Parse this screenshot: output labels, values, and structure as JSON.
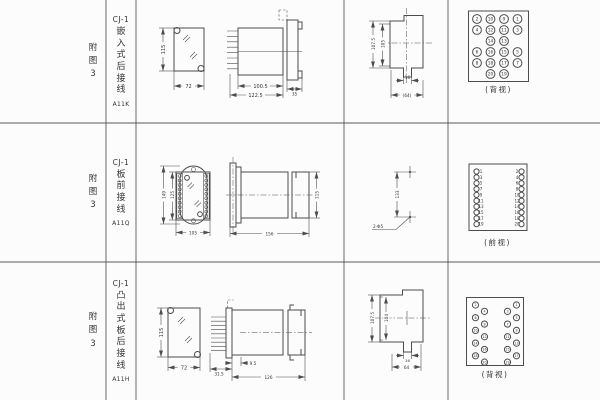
{
  "page": {
    "background": "#fcfcfc",
    "ink": "#4d4d4d"
  },
  "rows": [
    {
      "fig_chars": [
        "附",
        "图",
        "3"
      ],
      "model": "CJ-1",
      "mount_chars": [
        "嵌",
        "入",
        "式",
        "后",
        "接",
        "线"
      ],
      "code": "A11K",
      "front": {
        "h": "115",
        "w": "72"
      },
      "side": {
        "d1": "100.5",
        "d2": "122.5",
        "d3": "35"
      },
      "cutout": {
        "h1": "107.5",
        "h2": "105",
        "w1": "16",
        "w2": "(64)"
      },
      "terminal_view": {
        "caption": "(背视)",
        "grid": [
          [
            2,
            10,
            9,
            1
          ],
          [
            4,
            12,
            11,
            3
          ],
          [
            null,
            14,
            13,
            null
          ],
          [
            6,
            16,
            15,
            5
          ],
          [
            8,
            18,
            17,
            7
          ],
          [
            null,
            20,
            19,
            null
          ]
        ]
      }
    },
    {
      "fig_chars": [
        "附",
        "图",
        "3"
      ],
      "model": "CJ-1",
      "mount_chars": [
        "板",
        "前",
        "接",
        "线"
      ],
      "code": "A11Q",
      "front": {
        "h1": "149",
        "h2": "125",
        "w": "105"
      },
      "side": {
        "len": "156",
        "h": "115"
      },
      "holes": {
        "dist": "133",
        "label": "2-Φ5"
      },
      "terminal_view": {
        "caption": "(前视)",
        "left": [
          1,
          3,
          5,
          7,
          9,
          11,
          13,
          15,
          17,
          19
        ],
        "right": [
          2,
          4,
          6,
          8,
          10,
          12,
          14,
          16,
          18,
          20
        ]
      }
    },
    {
      "fig_chars": [
        "附",
        "图",
        "3"
      ],
      "model": "CJ-1",
      "mount_chars": [
        "凸",
        "出",
        "式",
        "板",
        "后",
        "接",
        "线"
      ],
      "code": "A11H",
      "front": {
        "h": "115",
        "w": "72"
      },
      "side": {
        "d1": "9.5",
        "d2": "31.5",
        "d3": "126"
      },
      "cutout": {
        "h1": "107.5",
        "h2": "104",
        "w1": "16",
        "w2": "64"
      },
      "terminal_view": {
        "caption": "(背视)",
        "left_zigzag": [
          2,
          4,
          6,
          8,
          10,
          12,
          14,
          16,
          18,
          20
        ],
        "right_zigzag": [
          1,
          3,
          5,
          7,
          9,
          11,
          13,
          15,
          17,
          19
        ]
      }
    }
  ]
}
